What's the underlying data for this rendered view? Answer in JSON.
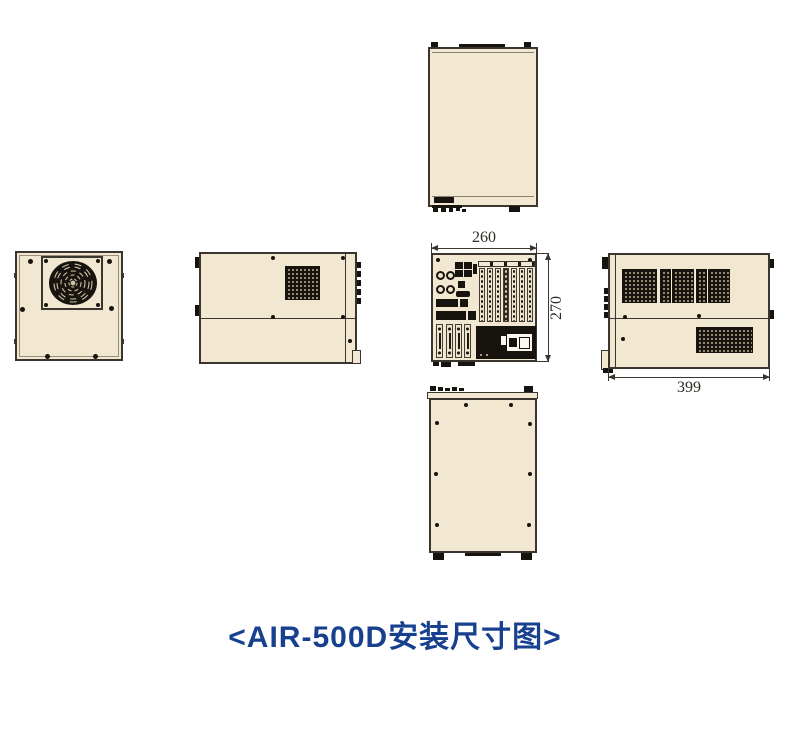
{
  "caption": "<AIR-500D安装尺寸图>",
  "dimensions": {
    "rear_width": "260",
    "rear_height": "270",
    "side_depth": "399"
  },
  "colors": {
    "chassis_fill": "#f2e7d0",
    "outline": "#3a352e",
    "vent_black": "#17140f",
    "caption_blue": "#17418f",
    "background": "#ffffff"
  },
  "icons": {
    "fan": "fan-grille-icon",
    "vent": "perforated-vent",
    "expansion_slots": "expansion-slot-covers",
    "power_supply": "psu-block"
  }
}
